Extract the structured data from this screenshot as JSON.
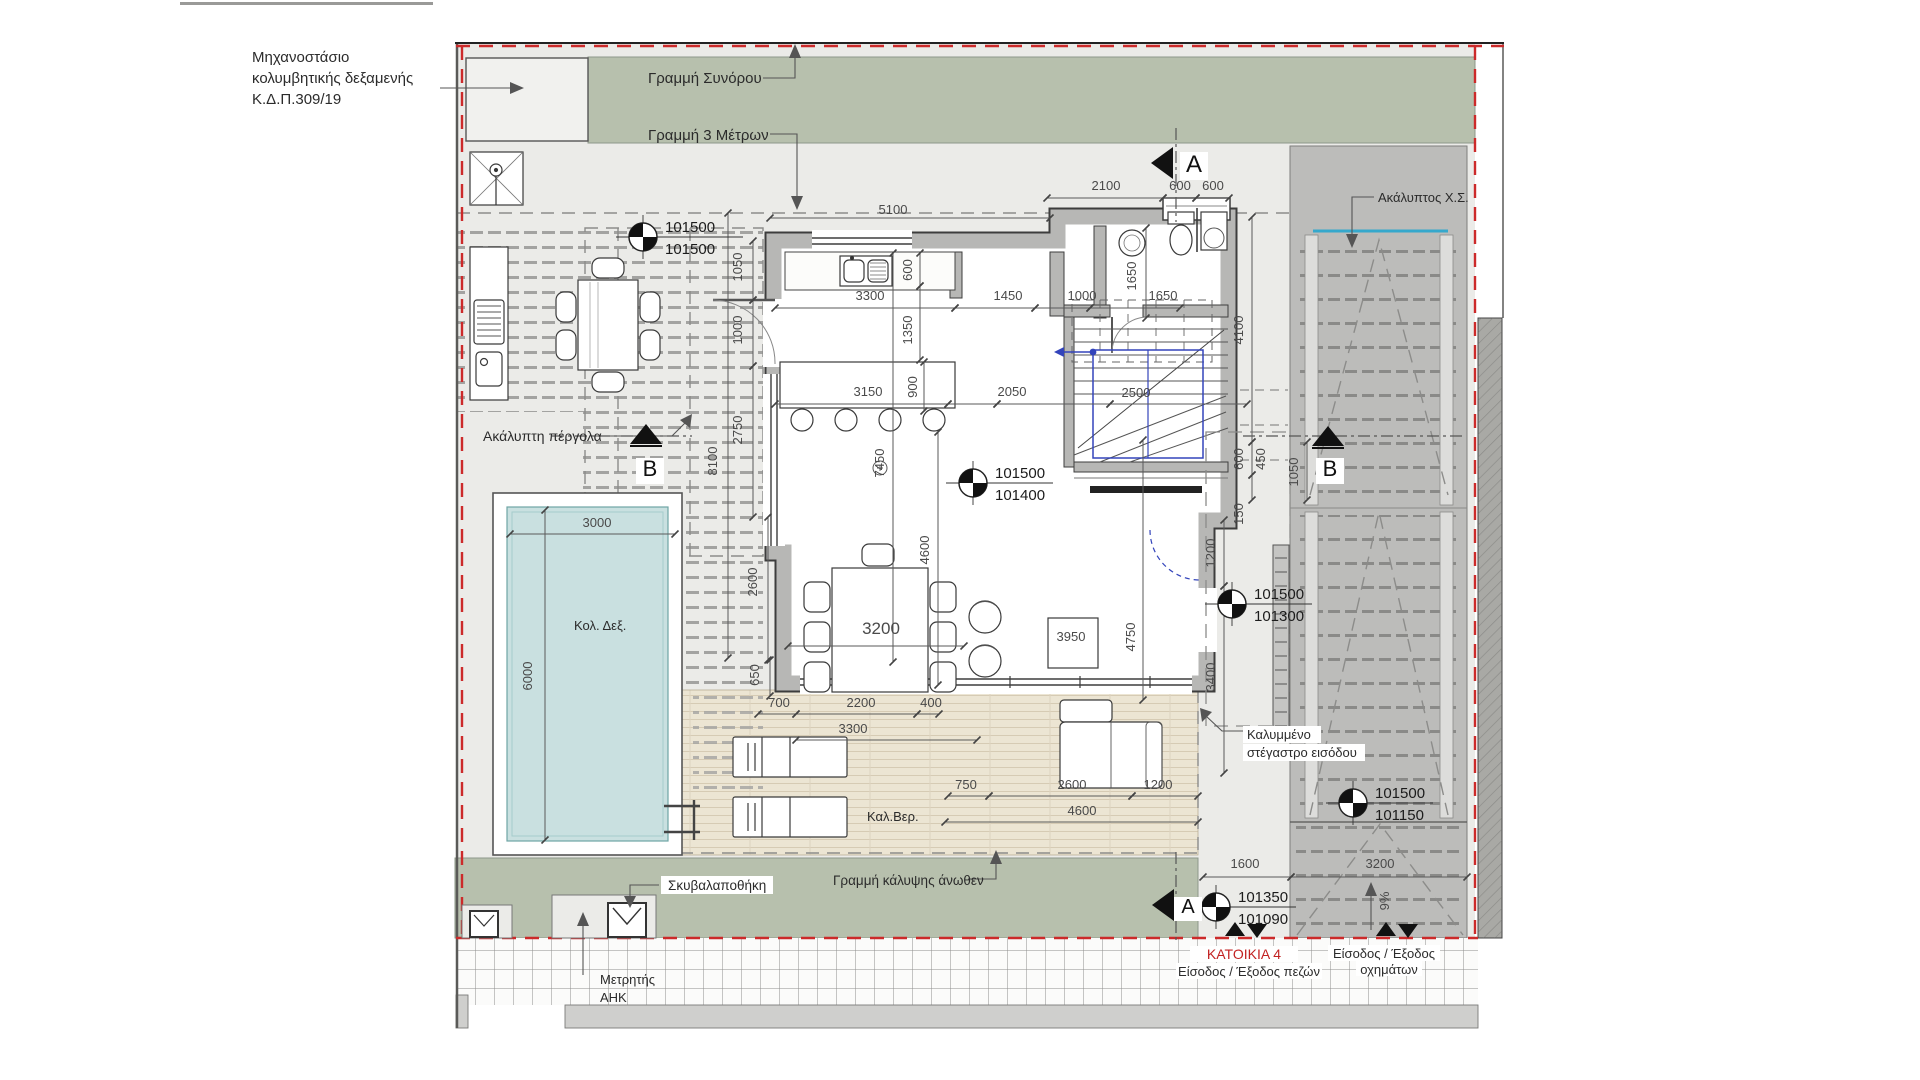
{
  "drawing": {
    "type": "architectural-floor-plan",
    "house_id": "ΚΑΤΟΙΚΙΑ 4"
  },
  "colors": {
    "green_area": "#b7c0ad",
    "yard": "#ebebe8",
    "machinery_room": "#f1f1ee",
    "driveway": "#bcbcba",
    "deck": "#ece5d3",
    "pool_water": "#c9e0e0",
    "wall_fill": "#b7b7b5",
    "wall_edge": "#3d3d3d",
    "boundary_red": "#cc2a2a",
    "stair_blue": "#3344bb",
    "cyan_edge": "#35a8cc",
    "house_label_red": "#c22222"
  },
  "labels": [
    {
      "id": "machinery-1",
      "t": "Μηχανοστάσιο",
      "x": 252,
      "y": 62
    },
    {
      "id": "machinery-2",
      "t": "κολυμβητικής δεξαμενής",
      "x": 252,
      "y": 83
    },
    {
      "id": "machinery-3",
      "t": "Κ.Δ.Π.309/19",
      "x": 252,
      "y": 104
    },
    {
      "id": "boundary-line",
      "t": "Γραμμή Συνόρου",
      "x": 648,
      "y": 83
    },
    {
      "id": "three-meter-line",
      "t": "Γραμμή 3 Μέτρων",
      "x": 648,
      "y": 140
    },
    {
      "id": "uncovered-parking",
      "t": "Ακάλυπτος Χ.Σ.",
      "x": 1378,
      "y": 202,
      "s": 13
    },
    {
      "id": "pergola",
      "t": "Ακάλυπτη πέργολα",
      "x": 483,
      "y": 441,
      "s": 14
    },
    {
      "id": "pool",
      "t": "Κολ. Δεξ.",
      "x": 574,
      "y": 630,
      "s": 13
    },
    {
      "id": "veranda",
      "t": "Καλ.Βερ.",
      "x": 867,
      "y": 821,
      "s": 13
    },
    {
      "id": "garbage-store",
      "t": "Σκυβαλαποθήκη",
      "x": 668,
      "y": 890,
      "s": 13.5,
      "bg": [
        661,
        876,
        112,
        18
      ]
    },
    {
      "id": "coverage-line",
      "t": "Γραμμή κάλυψης άνωθεν",
      "x": 833,
      "y": 885,
      "s": 13.5
    },
    {
      "id": "meter-1",
      "t": "Μετρητής",
      "x": 600,
      "y": 984,
      "s": 13
    },
    {
      "id": "meter-2",
      "t": "ΑΗΚ",
      "x": 600,
      "y": 1002,
      "s": 13
    },
    {
      "id": "entrance-canopy-1",
      "t": "Καλυμμένο",
      "x": 1247,
      "y": 739,
      "s": 13,
      "bg": [
        1243,
        726,
        78,
        17
      ]
    },
    {
      "id": "entrance-canopy-2",
      "t": "στέγαστρο εισόδου",
      "x": 1247,
      "y": 757,
      "s": 13,
      "bg": [
        1243,
        744,
        122,
        17
      ]
    },
    {
      "id": "house-4",
      "t": "ΚΑΤΟΙΚΙΑ 4",
      "x": 1244,
      "y": 959,
      "s": 14,
      "color": "#c22222",
      "anchor": "middle",
      "bg": [
        1190,
        946,
        108,
        16
      ]
    },
    {
      "id": "pedestrian-entrance",
      "t": "Είσοδος / Έξοδος πεζών",
      "x": 1249,
      "y": 976,
      "s": 13,
      "anchor": "middle",
      "bg": [
        1176,
        963,
        146,
        16
      ]
    },
    {
      "id": "vehicle-entrance-1",
      "t": "Είσοδος / Έξοδος",
      "x": 1384,
      "y": 958,
      "s": 13,
      "anchor": "middle",
      "bg": [
        1328,
        945,
        112,
        16
      ]
    },
    {
      "id": "vehicle-entrance-2",
      "t": "οχημάτων",
      "x": 1389,
      "y": 974,
      "s": 13,
      "anchor": "middle",
      "bg": [
        1356,
        961,
        66,
        15
      ]
    }
  ],
  "dimensions": [
    {
      "t": "5100",
      "x": 893,
      "y": 214
    },
    {
      "t": "2100",
      "x": 1106,
      "y": 190
    },
    {
      "t": "600",
      "x": 1180,
      "y": 190
    },
    {
      "t": "600",
      "x": 1213,
      "y": 190
    },
    {
      "t": "3300",
      "x": 870,
      "y": 300
    },
    {
      "t": "1450",
      "x": 1008,
      "y": 300
    },
    {
      "t": "1000",
      "x": 1082,
      "y": 300
    },
    {
      "t": "1650",
      "x": 1163,
      "y": 300
    },
    {
      "t": "3150",
      "x": 868,
      "y": 396
    },
    {
      "t": "2050",
      "x": 1012,
      "y": 396
    },
    {
      "t": "2500",
      "x": 1136,
      "y": 397
    },
    {
      "t": "700",
      "x": 779,
      "y": 707
    },
    {
      "t": "2200",
      "x": 861,
      "y": 707
    },
    {
      "t": "400",
      "x": 931,
      "y": 707
    },
    {
      "t": "3300",
      "x": 853,
      "y": 733
    },
    {
      "t": "750",
      "x": 966,
      "y": 789
    },
    {
      "t": "2600",
      "x": 1072,
      "y": 789
    },
    {
      "t": "1200",
      "x": 1158,
      "y": 789
    },
    {
      "t": "4600",
      "x": 1082,
      "y": 815
    },
    {
      "t": "3000",
      "x": 597,
      "y": 527
    },
    {
      "t": "3200",
      "x": 881,
      "y": 634,
      "s": 17
    },
    {
      "t": "3950",
      "x": 1071,
      "y": 641
    },
    {
      "t": "1600",
      "x": 1245,
      "y": 868
    },
    {
      "t": "3200",
      "x": 1380,
      "y": 868
    },
    {
      "t": "1050",
      "x": 742,
      "y": 267,
      "r": -90
    },
    {
      "t": "1000",
      "x": 742,
      "y": 330,
      "r": -90
    },
    {
      "t": "600",
      "x": 912,
      "y": 270,
      "r": -90
    },
    {
      "t": "1350",
      "x": 912,
      "y": 330,
      "r": -90
    },
    {
      "t": "900",
      "x": 917,
      "y": 387,
      "r": -90
    },
    {
      "t": "7450",
      "x": 884,
      "y": 463,
      "r": -90
    },
    {
      "t": "4600",
      "x": 929,
      "y": 550,
      "r": -90
    },
    {
      "t": "2750",
      "x": 742,
      "y": 430,
      "r": -90
    },
    {
      "t": "8100",
      "x": 717,
      "y": 461,
      "r": -90
    },
    {
      "t": "2600",
      "x": 757,
      "y": 582,
      "r": -90
    },
    {
      "t": "650",
      "x": 759,
      "y": 675,
      "r": -90
    },
    {
      "t": "6000",
      "x": 532,
      "y": 676,
      "r": -90
    },
    {
      "t": "1650",
      "x": 1136,
      "y": 276,
      "r": -90
    },
    {
      "t": "4100",
      "x": 1243,
      "y": 330,
      "r": -90
    },
    {
      "t": "600",
      "x": 1243,
      "y": 459,
      "r": -90
    },
    {
      "t": "450",
      "x": 1265,
      "y": 459,
      "r": -90
    },
    {
      "t": "1050",
      "x": 1298,
      "y": 472,
      "r": -90
    },
    {
      "t": "150",
      "x": 1243,
      "y": 514,
      "r": -90
    },
    {
      "t": "1200",
      "x": 1215,
      "y": 553,
      "r": -90
    },
    {
      "t": "3400",
      "x": 1215,
      "y": 677,
      "r": -90
    },
    {
      "t": "4750",
      "x": 1135,
      "y": 637,
      "r": -90
    },
    {
      "t": "9%",
      "x": 1389,
      "y": 901,
      "r": -90
    }
  ],
  "level_markers": [
    {
      "top": "101500",
      "bottom": "101500",
      "x": 643,
      "y": 237,
      "len": 100
    },
    {
      "top": "101500",
      "bottom": "101400",
      "x": 973,
      "y": 483,
      "len": 80
    },
    {
      "top": "101500",
      "bottom": "101300",
      "x": 1232,
      "y": 604,
      "len": 80
    },
    {
      "top": "101500",
      "bottom": "101150",
      "x": 1353,
      "y": 803,
      "len": 80
    },
    {
      "top": "101350",
      "bottom": "101090",
      "x": 1216,
      "y": 907,
      "len": 80
    }
  ],
  "section_markers": [
    {
      "label": "A",
      "x": 1163,
      "y": 163,
      "dir": "left",
      "tx": 1194,
      "ty": 172,
      "s": 24
    },
    {
      "label": "A",
      "x": 1164,
      "y": 905,
      "dir": "left",
      "tx": 1188,
      "ty": 913,
      "s": 20
    },
    {
      "label": "B",
      "x": 646,
      "y": 436,
      "dir": "up",
      "tx": 650,
      "ty": 476,
      "s": 22
    },
    {
      "label": "B",
      "x": 1328,
      "y": 438,
      "dir": "up",
      "tx": 1330,
      "ty": 476,
      "s": 22
    }
  ]
}
